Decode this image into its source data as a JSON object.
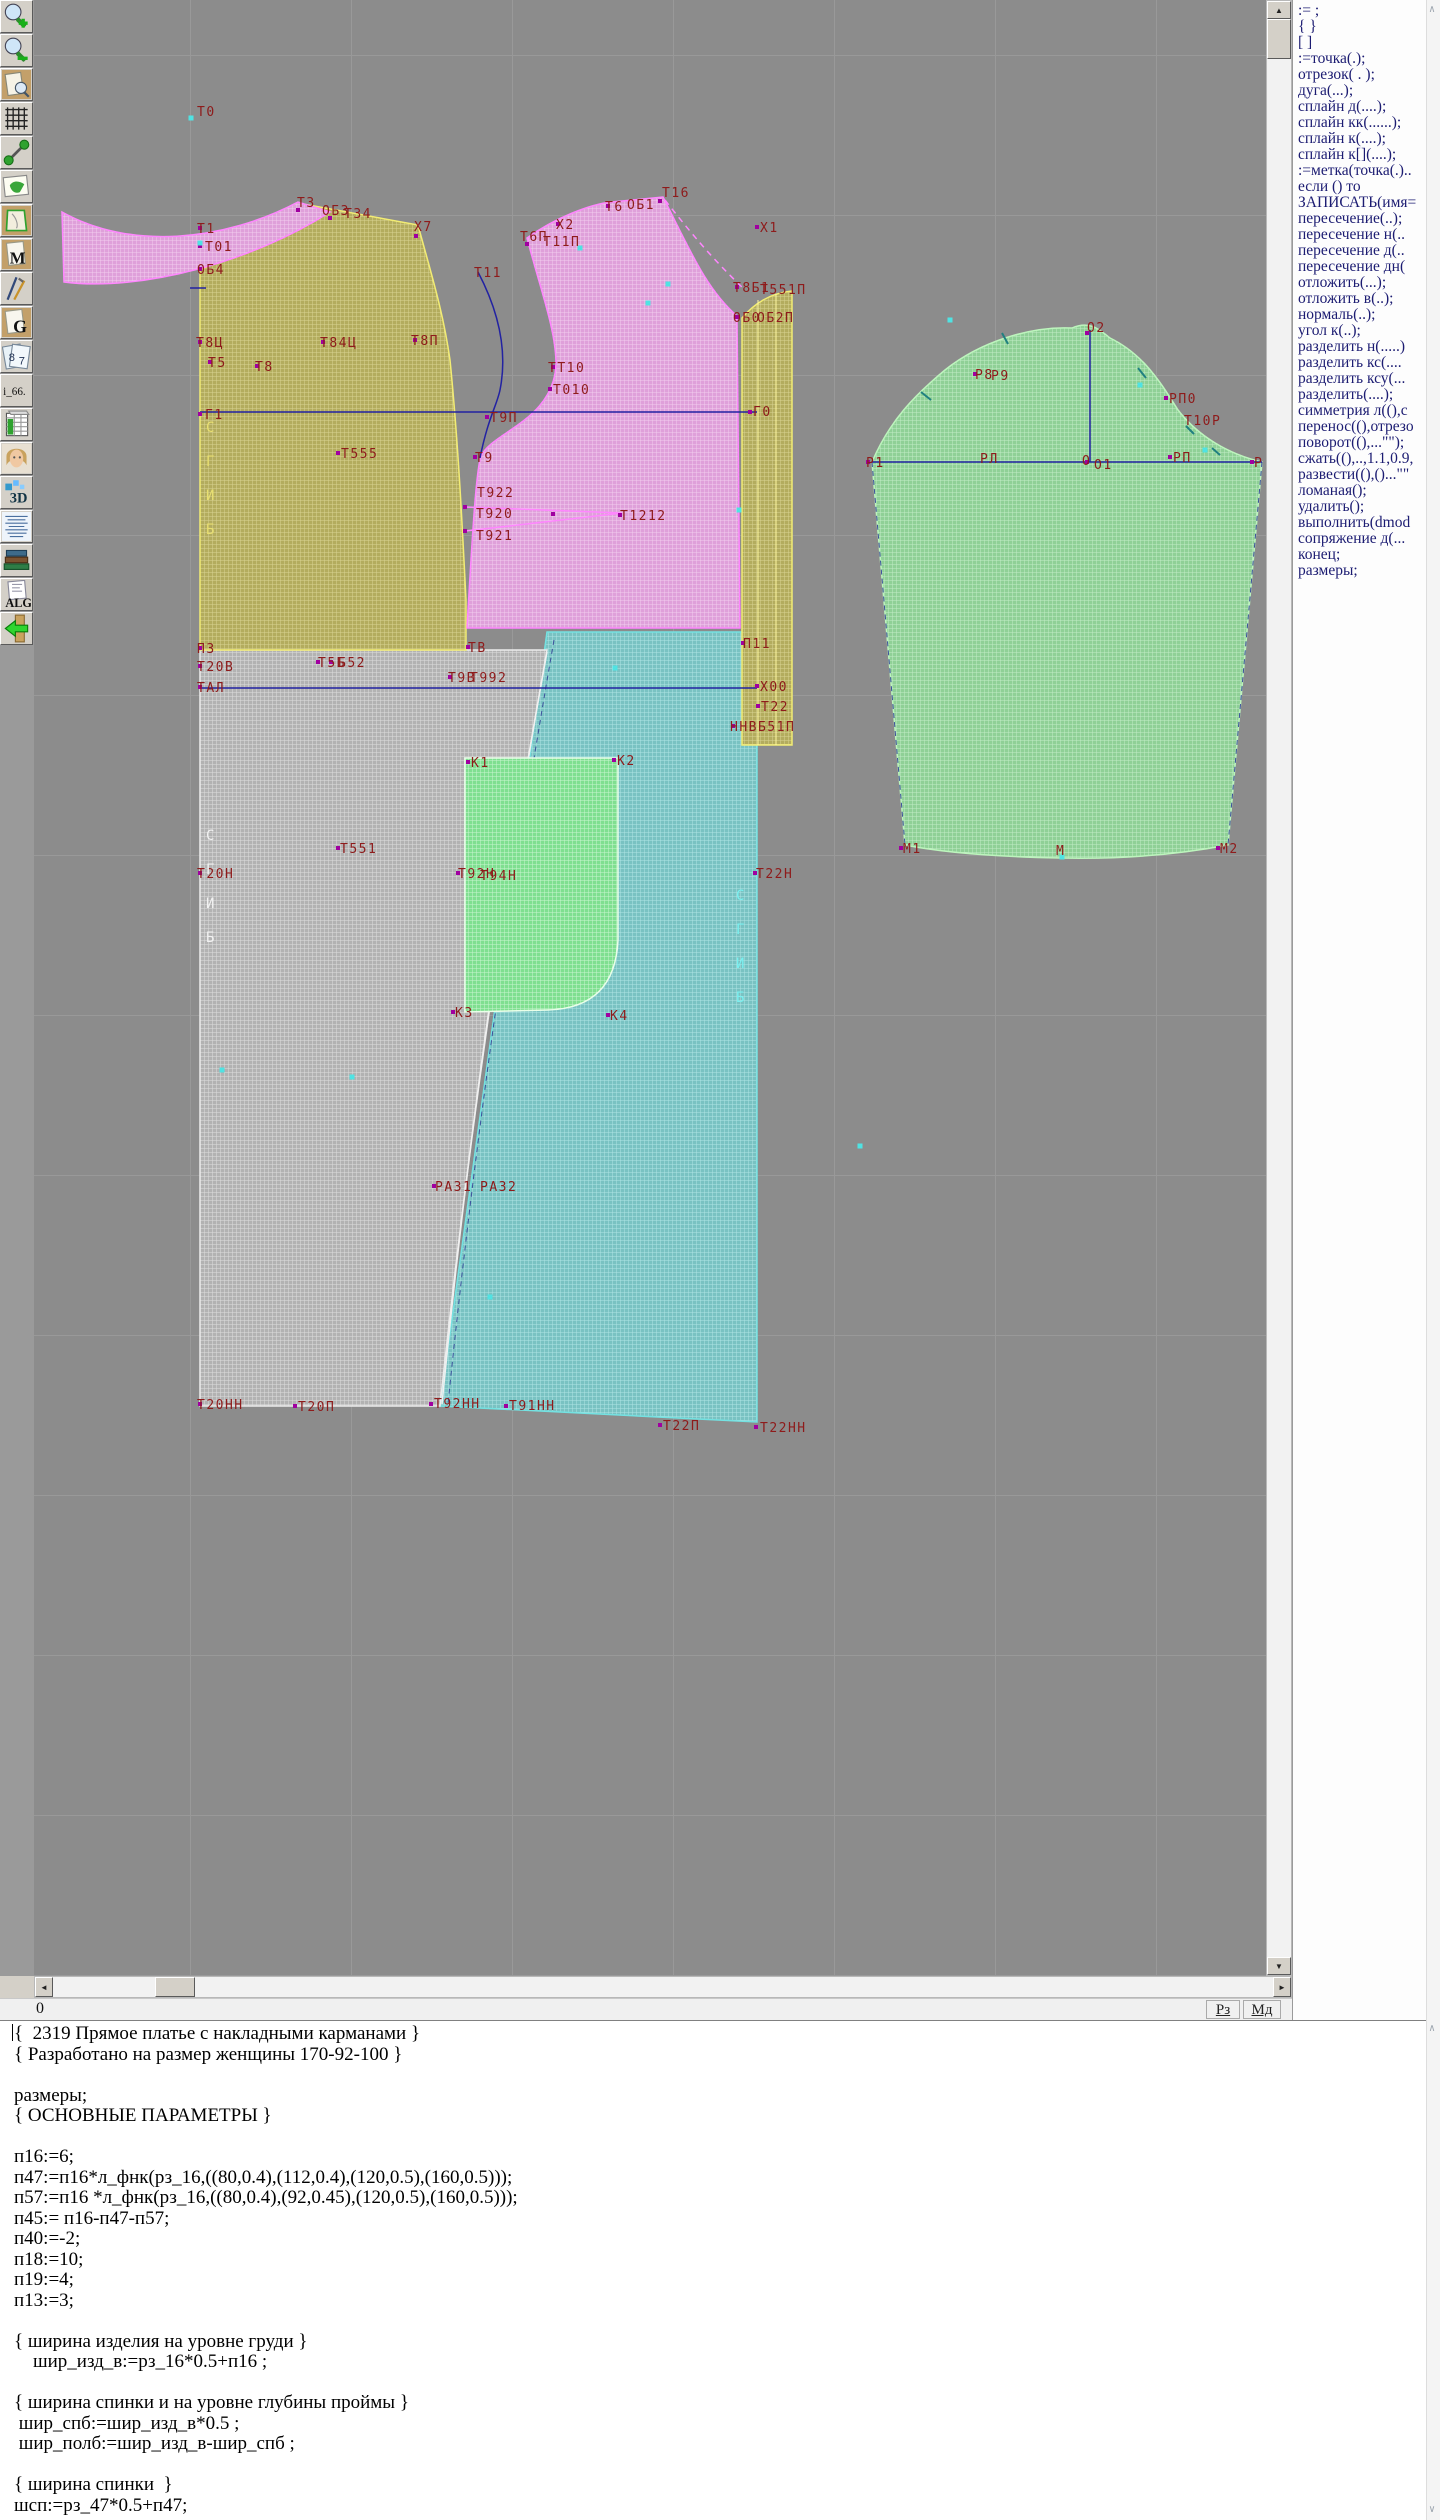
{
  "toolbar": {
    "buttons": [
      {
        "name": "zoom-in"
      },
      {
        "name": "zoom-out"
      },
      {
        "name": "print-preview"
      },
      {
        "name": "grid"
      },
      {
        "name": "measure"
      },
      {
        "name": "layout-map"
      },
      {
        "name": "pattern-piece"
      },
      {
        "name": "marking-m",
        "label": "M"
      },
      {
        "name": "draw-tools"
      },
      {
        "name": "graphs-g",
        "label": "G"
      },
      {
        "name": "sizes-sheet",
        "label": "8"
      },
      {
        "name": "size-i66",
        "label": "i_66."
      },
      {
        "name": "size-table"
      },
      {
        "name": "model-photo"
      },
      {
        "name": "view-3d",
        "label": "3D"
      },
      {
        "name": "text-list"
      },
      {
        "name": "reference-books"
      },
      {
        "name": "algorithms",
        "label": "ALG"
      },
      {
        "name": "exit"
      }
    ]
  },
  "canvas": {
    "background": "#8c8c8c",
    "label_color": "#8e1b1b",
    "line_color": "#2222a2",
    "pieces": [
      {
        "name": "collar-band",
        "color": "#e9a8e9"
      },
      {
        "name": "back-bodice",
        "color": "#b9b264"
      },
      {
        "name": "front-bodice",
        "color": "#e9a8e9"
      },
      {
        "name": "side-panel",
        "color": "#b9b264"
      },
      {
        "name": "back-skirt",
        "color": "#b5b5b5"
      },
      {
        "name": "front-skirt",
        "color": "#7cc4c4"
      },
      {
        "name": "pocket",
        "color": "#8fd79a"
      },
      {
        "name": "sleeve",
        "color": "#8fd79a"
      }
    ],
    "labels": [
      {
        "t": "Т0",
        "x": 197,
        "y": 116
      },
      {
        "t": "Т1",
        "x": 197,
        "y": 233
      },
      {
        "t": "Т01",
        "x": 205,
        "y": 251
      },
      {
        "t": "ОБ4",
        "x": 197,
        "y": 274
      },
      {
        "t": "Т3",
        "x": 297,
        "y": 207
      },
      {
        "t": "ОБ3",
        "x": 322,
        "y": 215
      },
      {
        "t": "Т34",
        "x": 344,
        "y": 218
      },
      {
        "t": "Х7",
        "x": 414,
        "y": 231
      },
      {
        "t": "Т8Ц",
        "x": 196,
        "y": 347
      },
      {
        "t": "Т84Ц",
        "x": 320,
        "y": 347
      },
      {
        "t": "Т8П",
        "x": 411,
        "y": 345
      },
      {
        "t": "Т5",
        "x": 208,
        "y": 367
      },
      {
        "t": "Т8",
        "x": 255,
        "y": 371
      },
      {
        "t": "Т16",
        "x": 662,
        "y": 197
      },
      {
        "t": "Т6",
        "x": 605,
        "y": 211
      },
      {
        "t": "ОБ1",
        "x": 627,
        "y": 209
      },
      {
        "t": "Х2",
        "x": 556,
        "y": 229
      },
      {
        "t": "Т6П",
        "x": 520,
        "y": 241
      },
      {
        "t": "Т11П",
        "x": 543,
        "y": 246
      },
      {
        "t": "Т11",
        "x": 474,
        "y": 277
      },
      {
        "t": "Х1",
        "x": 760,
        "y": 232
      },
      {
        "t": "Т8Б1",
        "x": 733,
        "y": 292
      },
      {
        "t": "Т551П",
        "x": 760,
        "y": 294
      },
      {
        "t": "ОБ0",
        "x": 733,
        "y": 322
      },
      {
        "t": "ОБ2П",
        "x": 757,
        "y": 322
      },
      {
        "t": "ТТ10",
        "x": 548,
        "y": 372
      },
      {
        "t": "Т010",
        "x": 553,
        "y": 394
      },
      {
        "t": "Т9П",
        "x": 490,
        "y": 422
      },
      {
        "t": "Г0",
        "x": 753,
        "y": 416
      },
      {
        "t": "Г1",
        "x": 205,
        "y": 419
      },
      {
        "t": "Т555",
        "x": 341,
        "y": 458
      },
      {
        "t": "Т9",
        "x": 475,
        "y": 462
      },
      {
        "t": "Т922",
        "x": 477,
        "y": 497
      },
      {
        "t": "Т920",
        "x": 476,
        "y": 518
      },
      {
        "t": "Т921",
        "x": 476,
        "y": 540
      },
      {
        "t": "Т1212",
        "x": 620,
        "y": 520
      },
      {
        "t": "П3",
        "x": 197,
        "y": 653
      },
      {
        "t": "Т20В",
        "x": 197,
        "y": 671
      },
      {
        "t": "ТАЛ",
        "x": 197,
        "y": 692
      },
      {
        "t": "Т5Б",
        "x": 318,
        "y": 667
      },
      {
        "t": "Б52",
        "x": 338,
        "y": 667
      },
      {
        "t": "ТВ",
        "x": 468,
        "y": 652
      },
      {
        "t": "Т9В",
        "x": 448,
        "y": 682
      },
      {
        "t": "Т992",
        "x": 470,
        "y": 682
      },
      {
        "t": "П11",
        "x": 743,
        "y": 648
      },
      {
        "t": "Х00",
        "x": 760,
        "y": 691
      },
      {
        "t": "Т22",
        "x": 761,
        "y": 711
      },
      {
        "t": "ННВБ51П",
        "x": 730,
        "y": 731
      },
      {
        "t": "Т551",
        "x": 340,
        "y": 853
      },
      {
        "t": "Т20Н",
        "x": 197,
        "y": 878
      },
      {
        "t": "Т92Н",
        "x": 458,
        "y": 878
      },
      {
        "t": "Т94Н",
        "x": 480,
        "y": 880
      },
      {
        "t": "Т22Н",
        "x": 756,
        "y": 878
      },
      {
        "t": "К1",
        "x": 471,
        "y": 767
      },
      {
        "t": "К2",
        "x": 617,
        "y": 765
      },
      {
        "t": "К3",
        "x": 455,
        "y": 1017
      },
      {
        "t": "К4",
        "x": 610,
        "y": 1020
      },
      {
        "t": "РАЗ1",
        "x": 435,
        "y": 1191
      },
      {
        "t": "РАЗ2",
        "x": 480,
        "y": 1191
      },
      {
        "t": "Т20НН",
        "x": 197,
        "y": 1409
      },
      {
        "t": "Т20П",
        "x": 298,
        "y": 1411
      },
      {
        "t": "Т92НН",
        "x": 434,
        "y": 1408
      },
      {
        "t": "Т91НН",
        "x": 509,
        "y": 1410
      },
      {
        "t": "Т22П",
        "x": 663,
        "y": 1430
      },
      {
        "t": "Т22НН",
        "x": 760,
        "y": 1432
      },
      {
        "t": "О2",
        "x": 1087,
        "y": 332
      },
      {
        "t": "Р8",
        "x": 975,
        "y": 379
      },
      {
        "t": "Р9",
        "x": 991,
        "y": 380
      },
      {
        "t": "РП0",
        "x": 1169,
        "y": 403
      },
      {
        "t": "Т10Р",
        "x": 1184,
        "y": 425
      },
      {
        "t": "Р1",
        "x": 866,
        "y": 467
      },
      {
        "t": "РЛ",
        "x": 980,
        "y": 463
      },
      {
        "t": "О",
        "x": 1082,
        "y": 465
      },
      {
        "t": "О1",
        "x": 1094,
        "y": 469
      },
      {
        "t": "РП",
        "x": 1173,
        "y": 462
      },
      {
        "t": "Р",
        "x": 1254,
        "y": 467
      },
      {
        "t": "М1",
        "x": 903,
        "y": 853
      },
      {
        "t": "М",
        "x": 1056,
        "y": 855
      },
      {
        "t": "М2",
        "x": 1220,
        "y": 853
      }
    ],
    "fold_labels": [
      {
        "t": "СГИБ",
        "x": 206,
        "y": 432,
        "color": "#e8df70"
      },
      {
        "t": "СГИБ",
        "x": 206,
        "y": 840,
        "color": "#f2f2f2"
      },
      {
        "t": "СГИБ",
        "x": 736,
        "y": 900,
        "color": "#7af0f0"
      }
    ],
    "points": [
      [
        200,
        228
      ],
      [
        200,
        246
      ],
      [
        200,
        269
      ],
      [
        298,
        210
      ],
      [
        330,
        218
      ],
      [
        416,
        236
      ],
      [
        200,
        342
      ],
      [
        323,
        342
      ],
      [
        415,
        340
      ],
      [
        210,
        362
      ],
      [
        257,
        366
      ],
      [
        527,
        244
      ],
      [
        558,
        224
      ],
      [
        608,
        206
      ],
      [
        660,
        201
      ],
      [
        757,
        227
      ],
      [
        737,
        287
      ],
      [
        737,
        317
      ],
      [
        553,
        367
      ],
      [
        550,
        389
      ],
      [
        487,
        417
      ],
      [
        200,
        414
      ],
      [
        750,
        412
      ],
      [
        338,
        453
      ],
      [
        475,
        457
      ],
      [
        465,
        507
      ],
      [
        465,
        531
      ],
      [
        553,
        514
      ],
      [
        620,
        515
      ],
      [
        200,
        648
      ],
      [
        200,
        666
      ],
      [
        200,
        687
      ],
      [
        318,
        662
      ],
      [
        331,
        662
      ],
      [
        468,
        647
      ],
      [
        450,
        677
      ],
      [
        743,
        643
      ],
      [
        757,
        686
      ],
      [
        758,
        706
      ],
      [
        733,
        726
      ],
      [
        338,
        848
      ],
      [
        200,
        873
      ],
      [
        458,
        873
      ],
      [
        755,
        873
      ],
      [
        453,
        1012
      ],
      [
        608,
        1015
      ],
      [
        468,
        762
      ],
      [
        614,
        760
      ],
      [
        434,
        1186
      ],
      [
        200,
        1404
      ],
      [
        295,
        1406
      ],
      [
        431,
        1404
      ],
      [
        506,
        1406
      ],
      [
        660,
        1425
      ],
      [
        756,
        1427
      ],
      [
        868,
        462
      ],
      [
        975,
        374
      ],
      [
        1166,
        398
      ],
      [
        1087,
        462
      ],
      [
        1170,
        457
      ],
      [
        1252,
        462
      ],
      [
        901,
        848
      ],
      [
        1218,
        848
      ],
      [
        1087,
        333
      ]
    ],
    "cyan_points": [
      [
        191,
        118
      ],
      [
        200,
        243
      ],
      [
        580,
        248
      ],
      [
        648,
        303
      ],
      [
        668,
        284
      ],
      [
        739,
        510
      ],
      [
        615,
        668
      ],
      [
        352,
        1077
      ],
      [
        490,
        1297
      ],
      [
        860,
        1146
      ],
      [
        1062,
        857
      ],
      [
        222,
        1070
      ],
      [
        950,
        320
      ],
      [
        1140,
        385
      ],
      [
        1205,
        450
      ]
    ]
  },
  "right_panel": {
    "items": [
      ":= ;",
      "{  }",
      "[  ]",
      ":=точка(.);",
      "отрезок( . );",
      "дуга(...);",
      "сплайн  д(....);",
      "сплайн  кк(......);",
      "сплайн  к(....);",
      "сплайн  к[](....);",
      ":=метка(точка(.)..",
      "если () то",
      "ЗАПИСАТЬ(имя=",
      "пересечение(..);",
      "пересечение  н(..",
      "пересечение  д(..",
      "пересечение  дн(",
      "отложить(...);",
      "отложить  в(..);",
      "нормаль(..);",
      "угол  к(..);",
      "разделить  н(.....)",
      "разделить  кс(....",
      "разделить  ксу(...",
      "разделить(....);",
      "симметрия  л((),с",
      "перенос((),отрезо",
      "поворот((),...\"\");",
      "сжать((),..,1.1,0.9,",
      "развести((),()...\"\"",
      "ломаная();",
      "удалить();",
      "выполнить(dmod",
      "сопряжение  д(...",
      "конец;",
      "размеры;"
    ]
  },
  "statusbar": {
    "left": "0",
    "buttons": [
      "Рз",
      "Мд"
    ]
  },
  "editor": {
    "lines": [
      "{  2319 Прямое платье с накладными карманами }",
      "{ Разработано на размер женщины 170-92-100 }",
      "",
      "размеры;",
      "{ ОСНОВНЫЕ ПАРАМЕТРЫ }",
      "",
      "п16:=6;",
      "п47:=п16*л_фнк(рз_16,((80,0.4),(112,0.4),(120,0.5),(160,0.5)));",
      "п57:=п16 *л_фнк(рз_16,((80,0.4),(92,0.45),(120,0.5),(160,0.5)));",
      "п45:= п16-п47-п57;",
      "п40:=-2;",
      "п18:=10;",
      "п19:=4;",
      "п13:=3;",
      "",
      "{ ширина изделия на уровне груди }",
      "    шир_изд_в:=рз_16*0.5+п16 ;",
      "",
      "{ ширина спинки и на уровне глубины проймы }",
      " шир_спб:=шир_изд_в*0.5 ;",
      " шир_полб:=шир_изд_в-шир_спб ;",
      "",
      "{ ширина спинки  }",
      "шсп:=рз_47*0.5+п47;"
    ]
  }
}
